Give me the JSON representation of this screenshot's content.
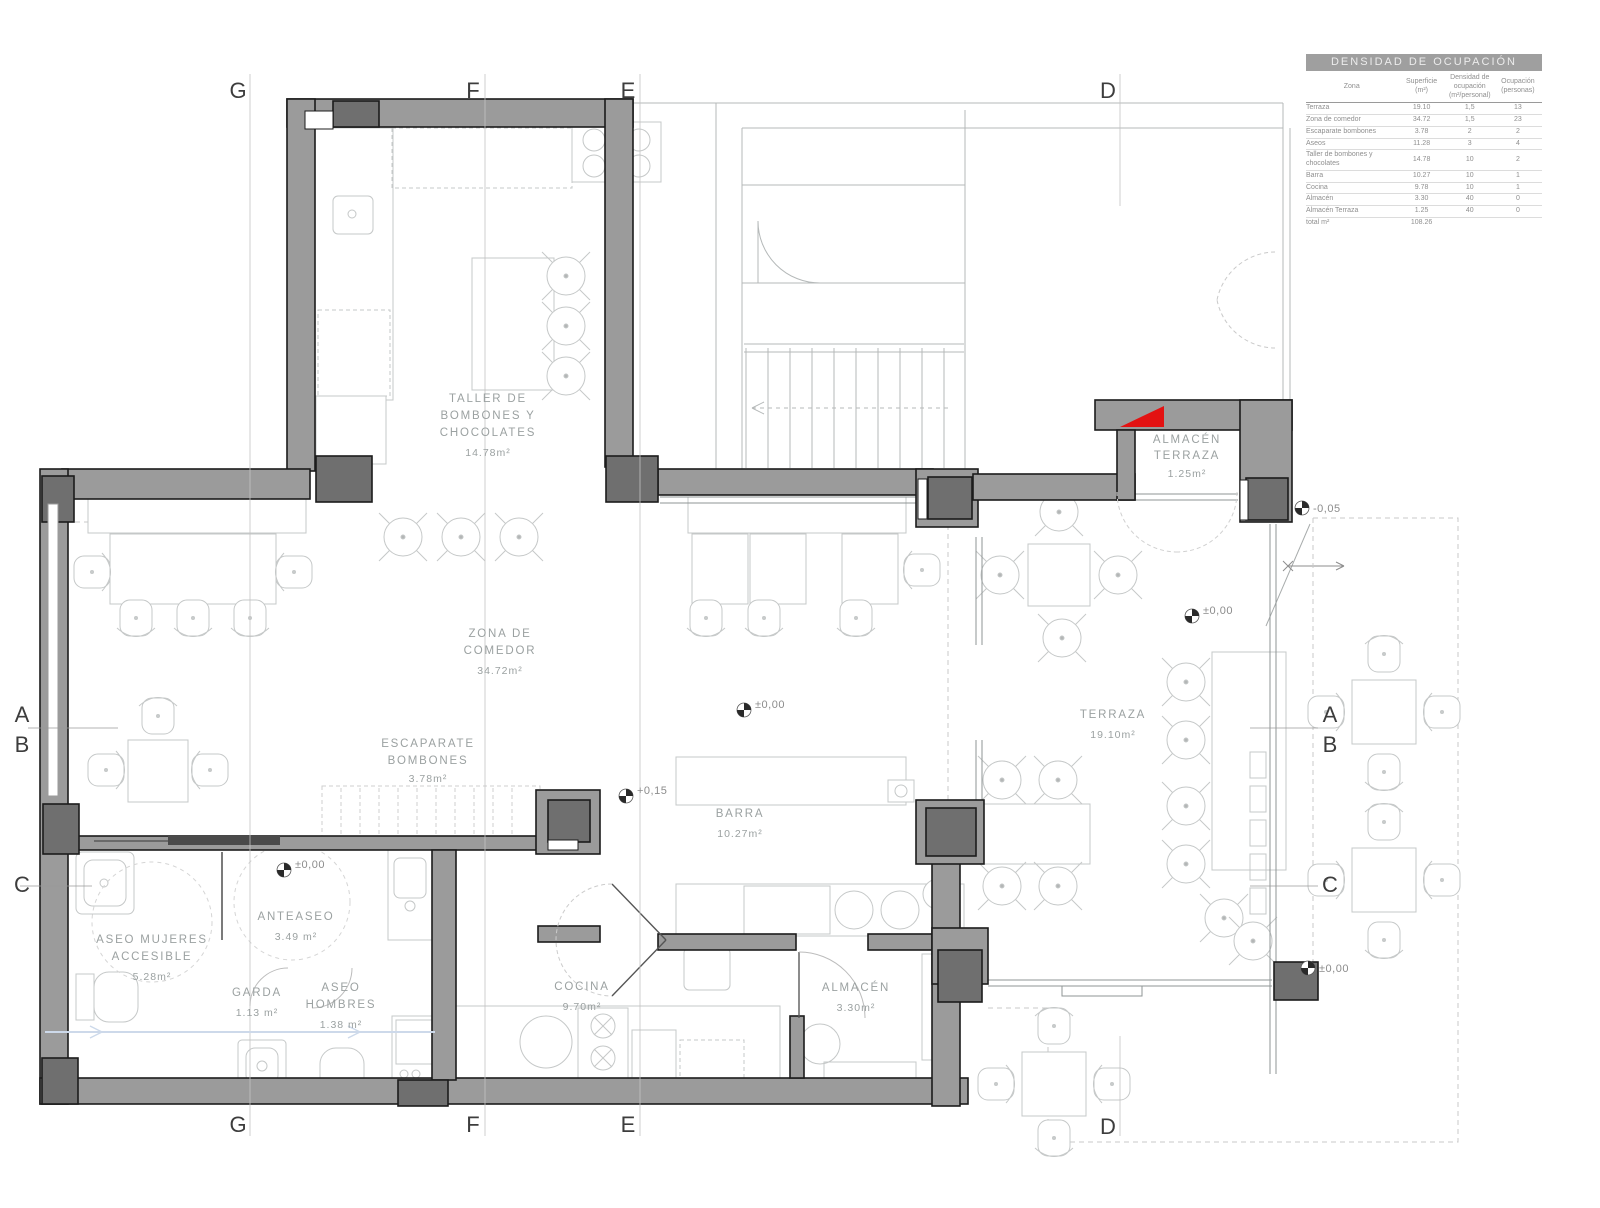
{
  "occupancy_table": {
    "title": "DENSIDAD DE OCUPACIÓN",
    "col_headers": [
      "Zona",
      "Superficie\n(m²)",
      "Densidad de\nocupación\n(m²/personal)",
      "Ocupación\n(personas)"
    ],
    "rows": [
      [
        "Terraza",
        "19.10",
        "1,5",
        "13"
      ],
      [
        "Zona de comedor",
        "34.72",
        "1,5",
        "23"
      ],
      [
        "Escaparate bombones",
        "3.78",
        "2",
        "2"
      ],
      [
        "Aseos",
        "11.28",
        "3",
        "4"
      ],
      [
        "Taller de bombones y chocolates",
        "14.78",
        "10",
        "2"
      ],
      [
        "Barra",
        "10.27",
        "10",
        "1"
      ],
      [
        "Cocina",
        "9.78",
        "10",
        "1"
      ],
      [
        "Almacén",
        "3.30",
        "40",
        "0"
      ],
      [
        "Almacén Terraza",
        "1.25",
        "40",
        "0"
      ]
    ],
    "total_label": "total m²",
    "total_superficie": "108.26"
  },
  "rooms": {
    "taller": {
      "name": [
        "TALLER DE",
        "BOMBONES Y",
        "CHOCOLATES"
      ],
      "area": "14.78m²"
    },
    "zona_comedor": {
      "name": [
        "ZONA DE",
        "COMEDOR"
      ],
      "area": "34.72m²"
    },
    "escaparate": {
      "name": [
        "ESCAPARATE",
        "BOMBONES"
      ],
      "area": "3.78m²"
    },
    "barra": {
      "name": [
        "BARRA"
      ],
      "area": "10.27m²"
    },
    "terraza": {
      "name": [
        "TERRAZA"
      ],
      "area": "19.10m²"
    },
    "almacen_terraza": {
      "name": [
        "ALMACÉN",
        "TERRAZA"
      ],
      "area": "1.25m²"
    },
    "aseo_mujeres": {
      "name": [
        "ASEO MUJERES",
        "ACCESIBLE"
      ],
      "area": "5.28m²"
    },
    "anteaseo": {
      "name": [
        "ANTEASEO"
      ],
      "area": "3.49 m²"
    },
    "garda": {
      "name": [
        "GARDA"
      ],
      "area": "1.13 m²"
    },
    "aseo_hombres": {
      "name": [
        "ASEO",
        "HOMBRES"
      ],
      "area": "1.38 m²"
    },
    "cocina": {
      "name": [
        "COCINA"
      ],
      "area": "9.70m²"
    },
    "almacen": {
      "name": [
        "ALMACÉN"
      ],
      "area": "3.30m²"
    }
  },
  "grid": {
    "cols": [
      "G",
      "F",
      "E",
      "D"
    ],
    "rows": [
      "A",
      "B",
      "C"
    ]
  },
  "level_markers": {
    "comedor": "±0,00",
    "barra": "+0,15",
    "terraza": "±0,00",
    "exterior_ne": "-0,05",
    "aseos": "±0,00",
    "exterior_se": "±0,00"
  },
  "colors": {
    "wall": "#9b9b9b",
    "pillar": "#6f6f6f",
    "outline": "#1c1c1c",
    "furniture_line": "#c5c8c8",
    "label_text": "#9ba1a1",
    "accent_red": "#e31212",
    "table_header_bg": "#9f9f9f"
  }
}
